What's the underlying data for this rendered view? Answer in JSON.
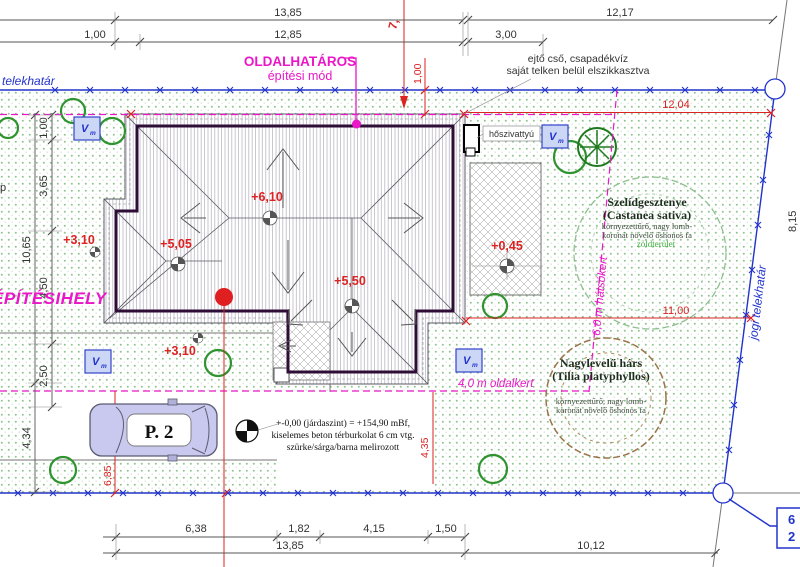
{
  "colors": {
    "boundary_blue": "#2233cc",
    "setback_magenta": "#ea16c8",
    "dimension_red": "#dd2222",
    "tree_green": "#2f9430",
    "roof_wall_dark": "#2e0d36",
    "plot_hatch_green": "#90c590",
    "car_body": "#c9c9ef"
  },
  "boundaries": {
    "left_label": "telekhatár",
    "right_label": "jogi telekhatár",
    "partial_left_text": "p",
    "parcel_no_line1": "6",
    "parcel_no_line2": "2"
  },
  "zoning": {
    "mode_line1": "OLDALHATÁROS",
    "mode_line2": "építési mód",
    "site_label": "ÉPÍTÉSIHELY",
    "rear_setback_label": "6,0 m hátsókert",
    "side_setback_label": "4,0 m oldalkert"
  },
  "notes": {
    "drain_line1": "ejtő cső, csapadékvíz",
    "drain_line2": "saját telken belül elszikkasztva",
    "heat_pump": "hőszivattyú",
    "pavement_line1": "+-0,00 (járdaszint) = +154,90 mBf,",
    "pavement_line2": "kiselemes beton térburkolat 6 cm vtg.",
    "pavement_line3": "szürke/sárga/barna melirozott"
  },
  "levels": {
    "ridge": "+6,10",
    "left_roof": "+5,05",
    "entry_roof": "+5,50",
    "terrace": "+0,45",
    "west_garden": "+3,10",
    "south_garden": "+3,10"
  },
  "trees": {
    "chestnut_name": "Szelídgesztenye",
    "chestnut_latin": "(Castanea sativa)",
    "chestnut_desc1": "környezettűrő, nagy lomb-",
    "chestnut_desc2": "koronát növelő őshonos fa",
    "chestnut_tag": "zöldterület",
    "linden_name": "Nagylevelű hárs",
    "linden_latin": "(Tilia platyphyllos)",
    "linden_desc1": "környezettűrő, nagy lomb-",
    "linden_desc2": "koronát növelő őshonos fa"
  },
  "parking": {
    "label": "P. 2"
  },
  "utility": {
    "label": "V",
    "sub": "m"
  },
  "dims": {
    "top": [
      "13,85",
      "1,00",
      "12,85",
      "12,17",
      "3,00"
    ],
    "left": [
      "1,00",
      "3,65",
      "4,50",
      "10,65",
      "2,50",
      "4,34"
    ],
    "bottom": [
      "6,38",
      "1,82",
      "4,15",
      "1,50",
      "13,85",
      "10,12"
    ],
    "right": [
      "8,15"
    ],
    "red": [
      "7,",
      "1,00",
      "12,04",
      "11,00",
      "4,35",
      "6,85"
    ]
  }
}
